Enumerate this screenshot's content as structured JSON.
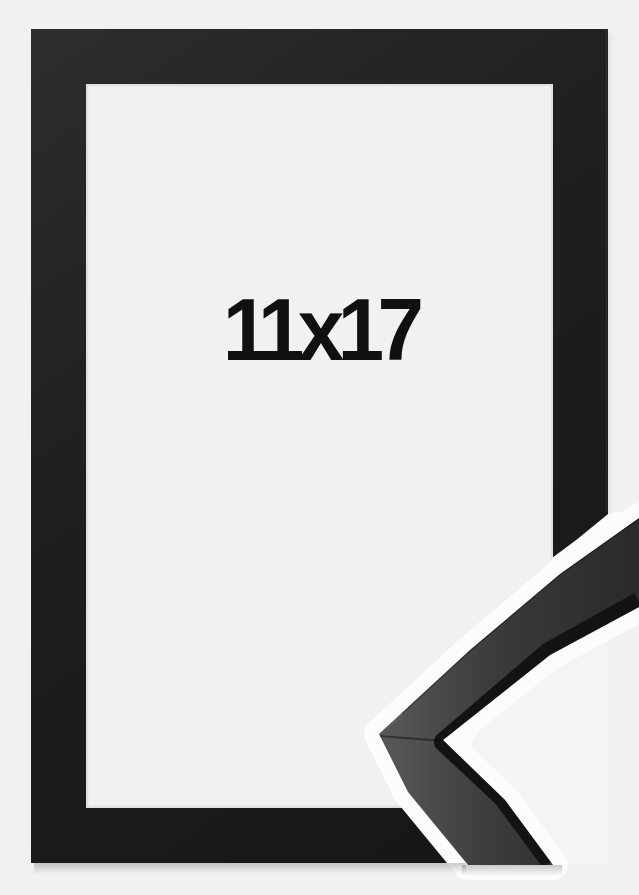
{
  "product": {
    "size_label": "11x17"
  },
  "colors": {
    "background": "#f1f1f2",
    "opening": "#f4f4f5",
    "frame_light": "#2d2d2d",
    "frame_mid": "#1f1f1f",
    "frame_dark": "#151515",
    "gap_white": "#fcfcfd",
    "sample_light": "#575757",
    "sample_mid": "#3a3a3a",
    "sample_dark": "#2b2b2b",
    "sample_edge": "#131313",
    "label_text": "#101010"
  }
}
